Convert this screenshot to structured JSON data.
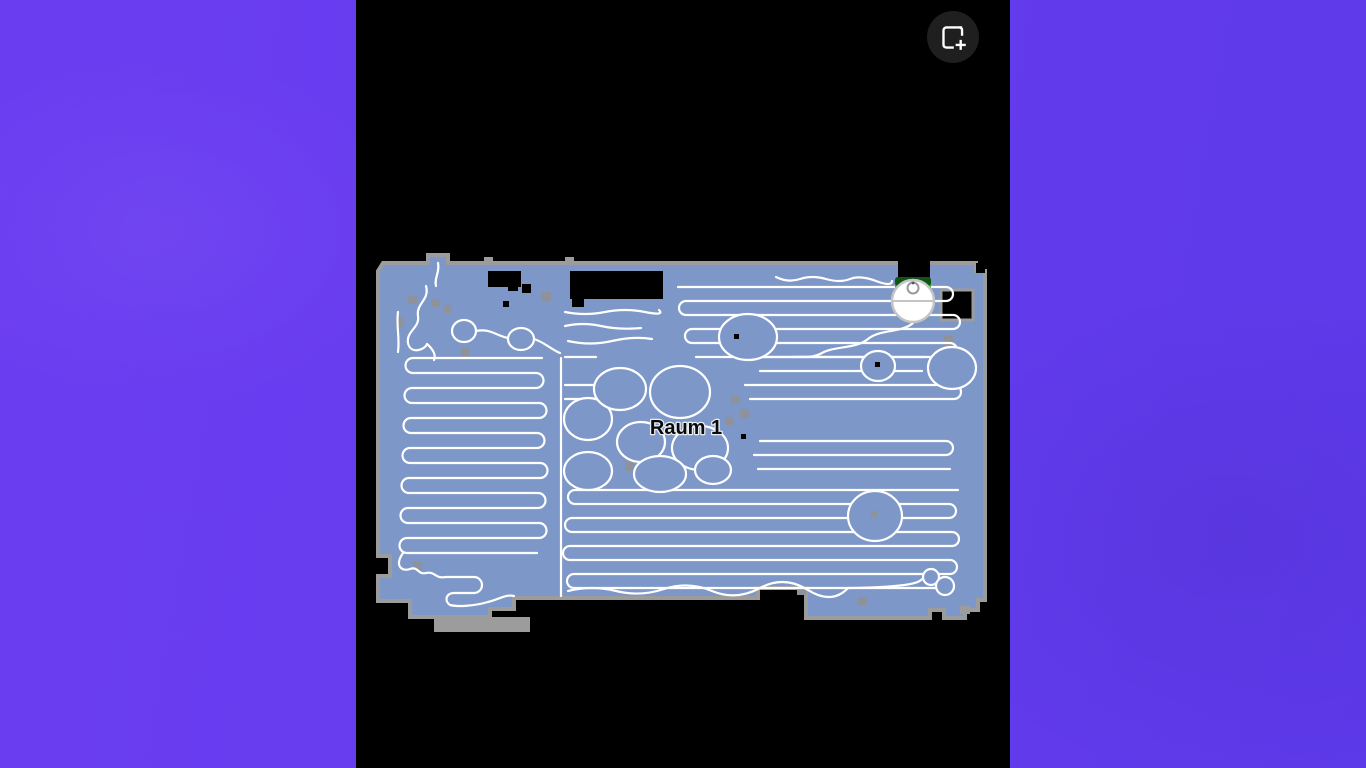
{
  "ui": {
    "background": {
      "left_color": "#6b3df1",
      "right_color": "#5c39e9"
    },
    "screen_color": "#000000",
    "add_map_button": {
      "background": "#1f1f1f",
      "icon_color": "#ffffff",
      "icon": "frame-plus-icon"
    }
  },
  "map": {
    "room": {
      "label": "Raum 1"
    },
    "robot": {
      "state": "docked",
      "dock": "charging-station"
    },
    "colors": {
      "floor": "#7d97c8",
      "border": "#9c9c9c",
      "path": "#ffffff",
      "cutout": "#000000",
      "obstacle": "#8e939b",
      "dock_green": "#2db43a",
      "dock_top": "#0d5415",
      "robot_body": "#ffffff",
      "robot_ring": "#c4c4c4",
      "robot_detail": "#9a9a9a",
      "label_text": "#0a0a0a",
      "label_halo": "#e9eef6"
    }
  }
}
